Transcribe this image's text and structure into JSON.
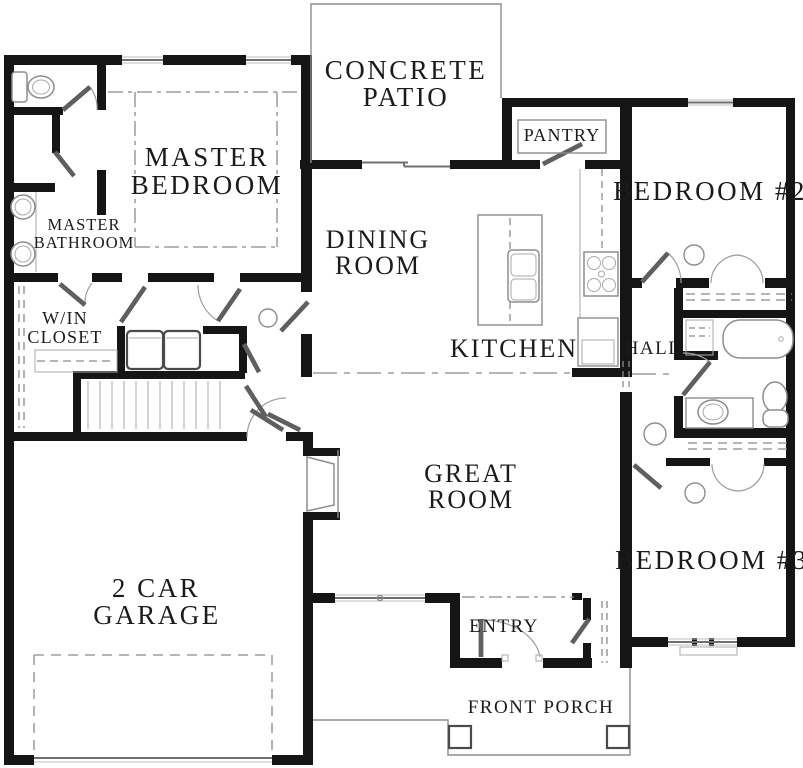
{
  "title": "Single-story house floor plan",
  "colors": {
    "wall": "#151515",
    "thin_line": "#8d8d8d",
    "text": "#1b1b1b",
    "background": "#ffffff"
  },
  "rooms": {
    "concrete_patio": {
      "lines": [
        "CONCRETE",
        "PATIO"
      ]
    },
    "master_bedroom": {
      "lines": [
        "MASTER",
        "BEDROOM"
      ]
    },
    "master_bathroom": {
      "lines": [
        "MASTER",
        "BATHROOM"
      ]
    },
    "win_closet": {
      "lines": [
        "W/IN",
        "CLOSET"
      ]
    },
    "pantry": {
      "lines": [
        "PANTRY"
      ]
    },
    "bedroom_2": {
      "lines": [
        "BEDROOM #2"
      ]
    },
    "dining_room": {
      "lines": [
        "DINING",
        "ROOM"
      ]
    },
    "kitchen": {
      "lines": [
        "KITCHEN"
      ]
    },
    "hall": {
      "lines": [
        "HALL"
      ]
    },
    "great_room": {
      "lines": [
        "GREAT",
        "ROOM"
      ]
    },
    "garage": {
      "lines": [
        "2 CAR",
        "GARAGE"
      ]
    },
    "bedroom_3": {
      "lines": [
        "BEDROOM #3"
      ]
    },
    "entry": {
      "lines": [
        "ENTRY"
      ]
    },
    "front_porch": {
      "lines": [
        "FRONT PORCH"
      ]
    }
  },
  "fixtures": [
    "toilet-icon",
    "double-sink-vanity-icon",
    "shower-icon",
    "bathtub-icon",
    "kitchen-island-sink-icon",
    "range-icon",
    "refrigerator-icon",
    "stairs-icon",
    "fireplace-icon",
    "washer-dryer-icon",
    "closet-rod-icon",
    "ceiling-light-icon",
    "porch-column-icon",
    "garage-door-icon",
    "window-icon",
    "door-swing-icon"
  ]
}
